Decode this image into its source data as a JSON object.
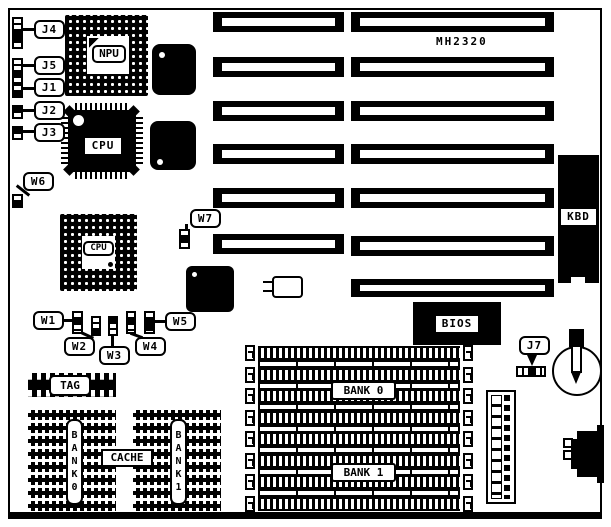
{
  "board": {
    "model": "MH2320"
  },
  "chips": {
    "npu": "NPU",
    "cpu_smd": "CPU",
    "cpu_socket": "CPU"
  },
  "jumpers": {
    "j1": {
      "label": "J1",
      "pins": 2
    },
    "j2": {
      "label": "J2",
      "pins": 2
    },
    "j3": {
      "label": "J3",
      "pins": 2
    },
    "j4": {
      "label": "J4",
      "pins": 5
    },
    "j5": {
      "label": "J5",
      "pins": 4
    },
    "j7": {
      "label": "J7",
      "pins": 5
    },
    "w1": {
      "label": "W1",
      "pins": 3
    },
    "w2": {
      "label": "W2",
      "pins": 3
    },
    "w3": {
      "label": "W3",
      "pins": 3
    },
    "w4": {
      "label": "W4",
      "pins": 3
    },
    "w5": {
      "label": "W5",
      "pins": 3
    },
    "w6": {
      "label": "W6",
      "pins": 2
    },
    "w7": {
      "label": "W7",
      "pins": 3
    }
  },
  "memory": {
    "cache_tag": "TAG",
    "cache_label": "CACHE",
    "cache_bank0": "BANK0",
    "cache_bank1": "BANK1",
    "dram_bank0": "BANK 0",
    "dram_bank1": "BANK 1",
    "simm_sockets": 8
  },
  "connectors": {
    "keyboard": "KBD",
    "bios": "BIOS"
  },
  "expansion_slots": {
    "left_column": 6,
    "right_column": 7
  },
  "colors": {
    "ink": "#000000",
    "paper": "#ffffff"
  }
}
